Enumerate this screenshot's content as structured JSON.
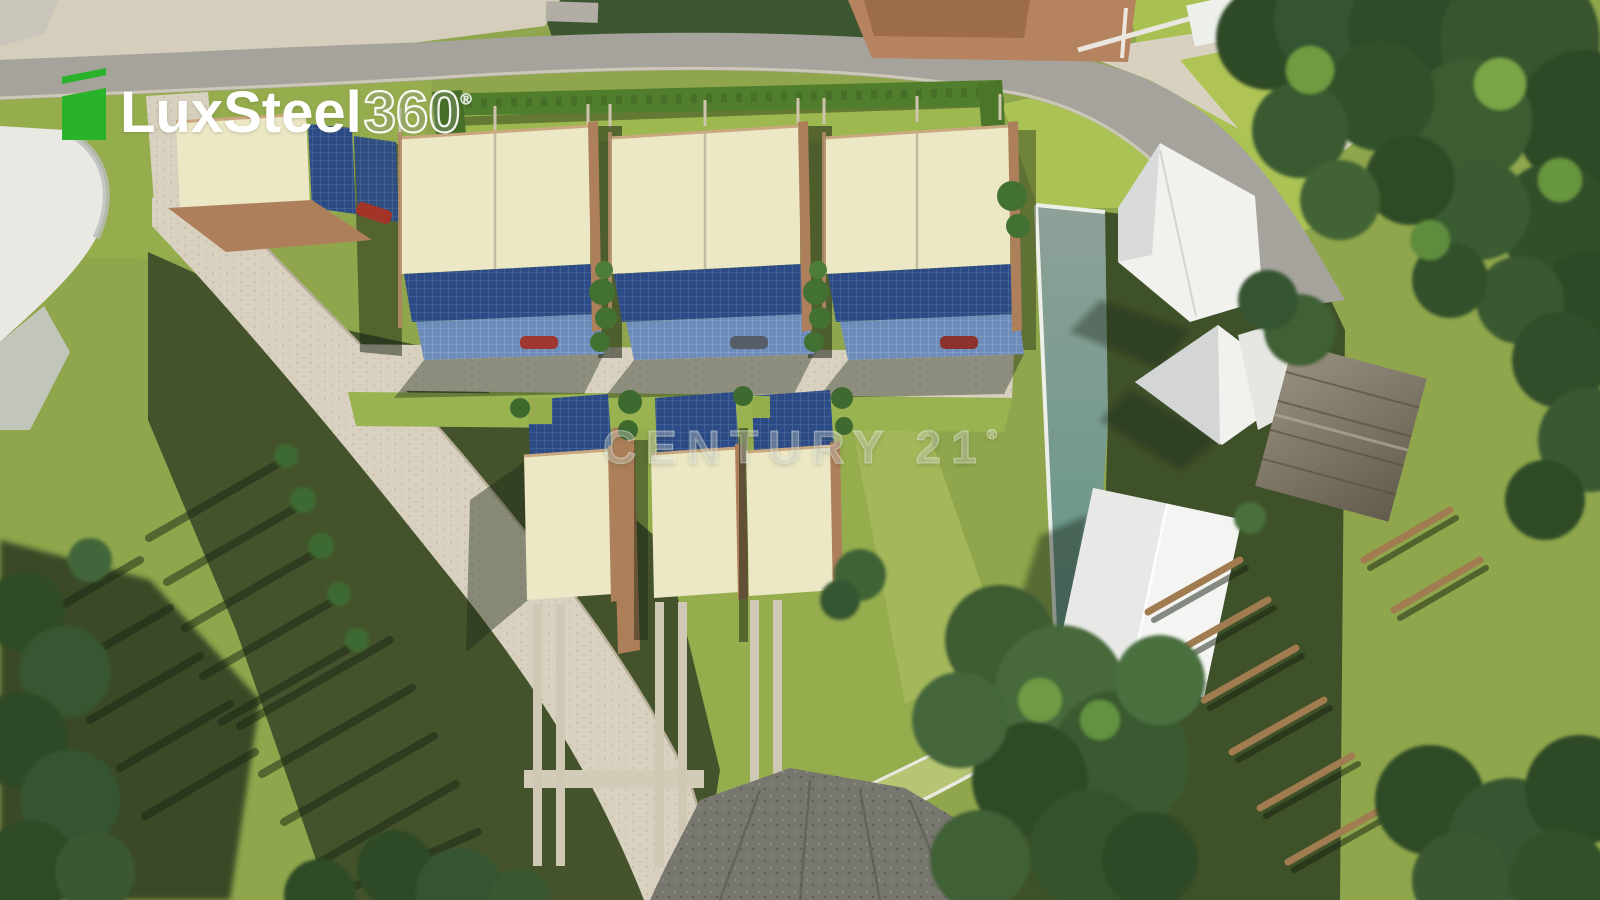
{
  "logo": {
    "brand": "LuxSteel",
    "suffix": "360",
    "registered": "®",
    "icon": "green-folded-page-icon"
  },
  "watermark": {
    "text": "CENTURY 21",
    "registered": "®"
  },
  "colors": {
    "logo_green": "#29b32b",
    "grass_light": "#8fa64c",
    "grass_bright": "#abc355",
    "grass_shadow": "#44532c",
    "tree_dark": "#33512c",
    "hedge_green": "#517e2d",
    "road_asphalt": "#a6a39d",
    "pavement_stone": "#d8d1c0",
    "gravel_dark": "#75746c",
    "roof_cream": "#ece7c5",
    "fascia_brown": "#ad7f5b",
    "solar_dark_blue": "#2c4b87",
    "solar_light_blue": "#6d8cba",
    "white_building": "#f1f1ee",
    "teal_wall": "#679488",
    "wood_gray": "#8a8171"
  },
  "site": {
    "townhouse_pairs_top_row": 3,
    "townhouse_units_top_row": 6,
    "detached_garage_units": 1,
    "townhouse_units_bottom_row": 3,
    "white_massing_houses": 4,
    "wood_cabins": 1
  }
}
